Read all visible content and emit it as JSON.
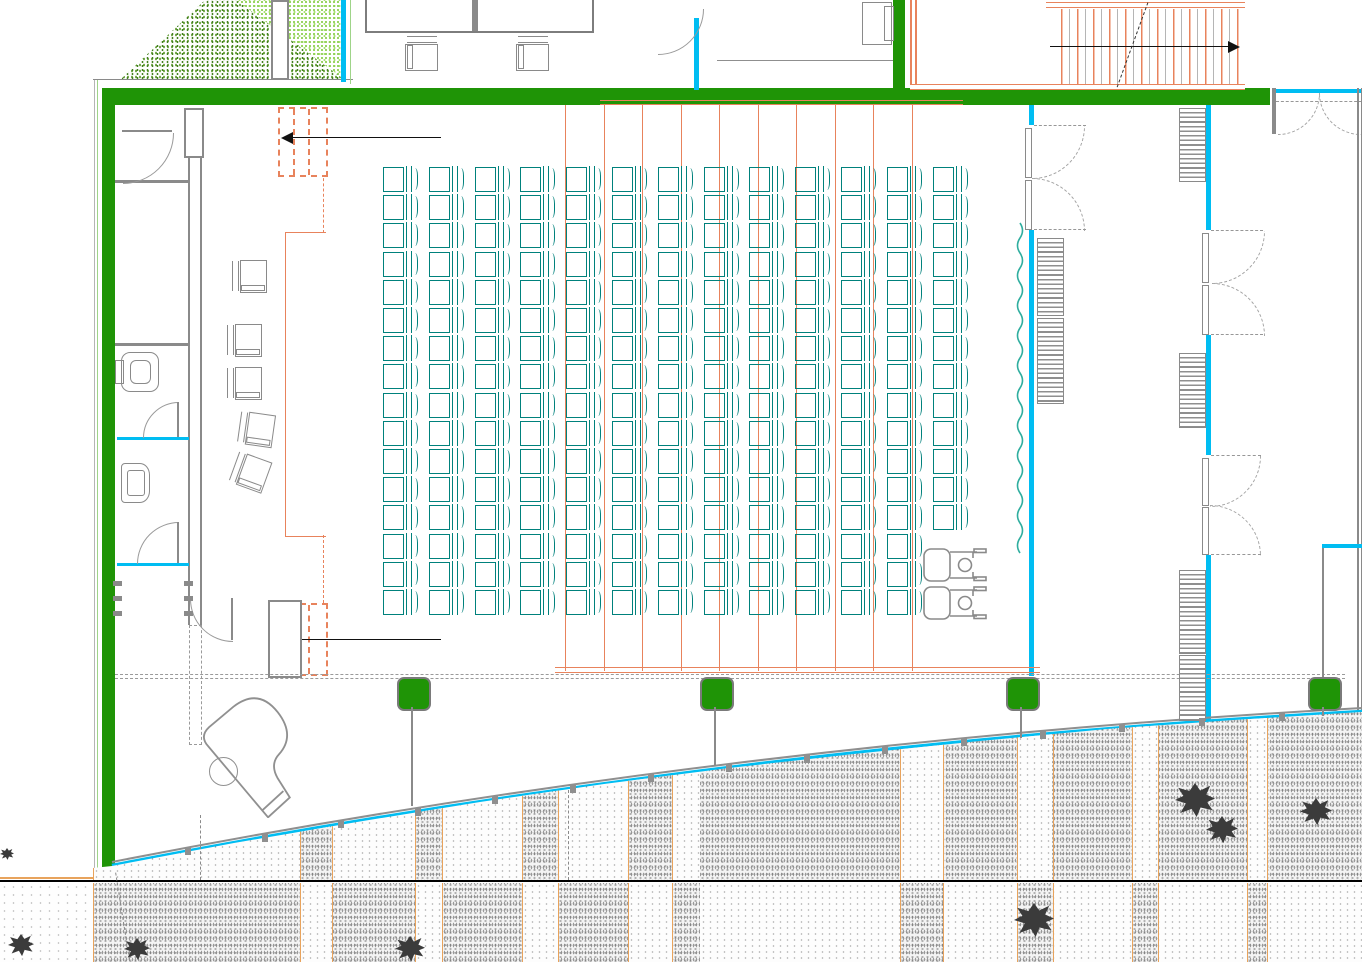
{
  "meta": {
    "kind": "cad-floor-plan",
    "description": "Architectural plan of an auditorium: teal seating grid, stage with stairs at left, WC corridor on far left, grand piano, glazed corridor with double doors at right, exterior stairs top-right, grass patch top-left, curved glass facade with paved sidewalk and trees at bottom",
    "width": 1362,
    "height": 962
  },
  "colors": {
    "wall_green": "#1f9406",
    "glass_cyan": "#00bdf2",
    "seat_teal": "#00817c",
    "cad_orange": "#e8835c",
    "pave_orange": "#e8a35c",
    "line_gray": "#8a8a8a",
    "tree_black": "#3b3b3b",
    "grass_dark": "#44801f",
    "grass_light": "#8ed052",
    "curtain_teal": "#2fae9f"
  },
  "seating": {
    "cols": 13,
    "rows": 16,
    "origin_x": 383,
    "origin_y": 166,
    "col_pitch": 45.8,
    "row_pitch": 28.2,
    "short_col_index": 12,
    "short_col_rows": 13,
    "total_seats": 205
  },
  "wheelchair_spots": [
    {
      "x": 922,
      "y": 545
    },
    {
      "x": 922,
      "y": 583
    }
  ],
  "beams": {
    "vertical_x": [
      565,
      604,
      642,
      681,
      719,
      758,
      796,
      835,
      873,
      912
    ],
    "top": 105,
    "bottom": 671,
    "h_top": {
      "y": 100,
      "x1": 600,
      "x2": 963
    },
    "h_bot": {
      "y": 667,
      "x1": 555,
      "x2": 1040
    }
  },
  "stage_chairs": [
    {
      "x": 232,
      "y": 259,
      "r": 0
    },
    {
      "x": 227,
      "y": 323,
      "r": 0
    },
    {
      "x": 227,
      "y": 366,
      "r": 0
    },
    {
      "x": 239,
      "y": 412,
      "r": 8
    },
    {
      "x": 233,
      "y": 455,
      "r": 20
    }
  ],
  "top_chairs": [
    {
      "x": 404,
      "y": 37,
      "r": 90
    },
    {
      "x": 515,
      "y": 37,
      "r": 90
    }
  ],
  "radiators": [
    {
      "x": 1037,
      "y": 238,
      "h": 76
    },
    {
      "x": 1037,
      "y": 318,
      "h": 84
    },
    {
      "x": 1179,
      "y": 108,
      "h": 72
    },
    {
      "x": 1179,
      "y": 353,
      "h": 73
    },
    {
      "x": 1179,
      "y": 570,
      "h": 82
    },
    {
      "x": 1179,
      "y": 655,
      "h": 64
    }
  ],
  "wall_ticks": {
    "xs": [
      113,
      184
    ],
    "ys": [
      581,
      596,
      611
    ]
  },
  "green_columns": [
    {
      "x": 397,
      "y": 677
    },
    {
      "x": 700,
      "y": 677
    },
    {
      "x": 1006,
      "y": 677
    },
    {
      "x": 1308,
      "y": 677
    }
  ],
  "column_stems": [
    {
      "x": 411,
      "y1": 707,
      "y2": 806
    },
    {
      "x": 714,
      "y1": 707,
      "y2": 766
    },
    {
      "x": 1020,
      "y1": 707,
      "y2": 738
    },
    {
      "x": 1322,
      "y1": 707,
      "y2": 716
    },
    {
      "x": 1322,
      "y1": 548,
      "y2": 677
    }
  ],
  "facade": {
    "p0": [
      112,
      866
    ],
    "p1": [
      720,
      747
    ],
    "p2": [
      1362,
      712
    ],
    "ticks": 15
  },
  "curtain": {
    "x": 1020,
    "y1": 223,
    "y2": 553,
    "amp": 5,
    "step": 15
  },
  "pavement": {
    "upper_bands": [
      {
        "x": 93,
        "w": 607,
        "t": "light"
      },
      {
        "x": 700,
        "w": 662,
        "t": "dense"
      },
      {
        "x": 300,
        "w": 32,
        "t": "dense"
      },
      {
        "x": 415,
        "w": 27,
        "t": "dense"
      },
      {
        "x": 522,
        "w": 36,
        "t": "dense"
      },
      {
        "x": 628,
        "w": 44,
        "t": "dense"
      },
      {
        "x": 900,
        "w": 43,
        "t": "light"
      },
      {
        "x": 1017,
        "w": 35,
        "t": "light"
      },
      {
        "x": 1132,
        "w": 26,
        "t": "light"
      },
      {
        "x": 1247,
        "w": 20,
        "t": "light"
      }
    ],
    "lower_bands": [
      {
        "x": 0,
        "w": 93,
        "t": "sparse"
      },
      {
        "x": 93,
        "w": 607,
        "t": "dense"
      },
      {
        "x": 700,
        "w": 662,
        "t": "light"
      },
      {
        "x": 300,
        "w": 32,
        "t": "light"
      },
      {
        "x": 415,
        "w": 27,
        "t": "light"
      },
      {
        "x": 522,
        "w": 36,
        "t": "light"
      },
      {
        "x": 628,
        "w": 44,
        "t": "light"
      },
      {
        "x": 900,
        "w": 43,
        "t": "dense"
      },
      {
        "x": 1017,
        "w": 36,
        "t": "dense"
      },
      {
        "x": 1132,
        "w": 26,
        "t": "dense"
      },
      {
        "x": 1247,
        "w": 20,
        "t": "dense"
      }
    ],
    "dividers_x": [
      93,
      300,
      332,
      415,
      442,
      522,
      558,
      628,
      672,
      900,
      943,
      1017,
      1053,
      1132,
      1158,
      1247,
      1267
    ]
  },
  "trees": [
    {
      "x": 0,
      "y": 848,
      "s": 14
    },
    {
      "x": 8,
      "y": 934,
      "s": 26
    },
    {
      "x": 124,
      "y": 938,
      "s": 26
    },
    {
      "x": 395,
      "y": 936,
      "s": 30
    },
    {
      "x": 1014,
      "y": 903,
      "s": 40
    },
    {
      "x": 1175,
      "y": 783,
      "s": 40
    },
    {
      "x": 1206,
      "y": 816,
      "s": 32
    },
    {
      "x": 1300,
      "y": 798,
      "s": 32
    }
  ]
}
